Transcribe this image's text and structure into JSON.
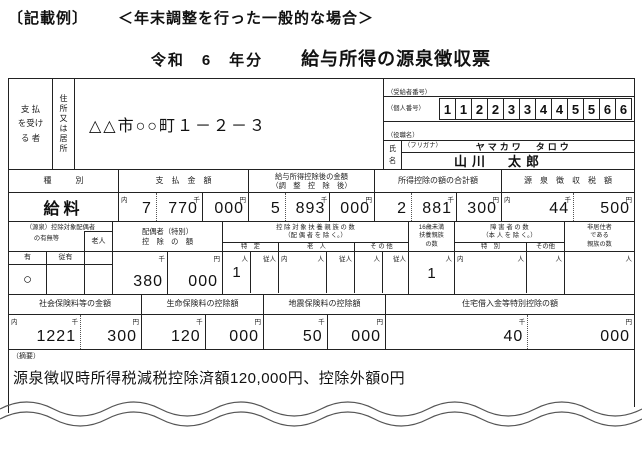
{
  "header": {
    "example_label": "〔記載例〕",
    "case_label": "＜年末調整を行った一般的な場合＞",
    "year_label": "令和　6　年分",
    "form_title": "給与所得の源泉徴収票"
  },
  "markers": {
    "uchi": "内",
    "sen": "千",
    "en": "円",
    "nin": "人",
    "junin": "従人"
  },
  "payee": {
    "payer_label_lines": [
      "支 払",
      "を受け",
      "る 者"
    ],
    "address_label": "住所又は居所",
    "address": "△△市○○町１－２－３",
    "recipient_no_label": "（受給者番号）",
    "personal_no_label": "（個人番号）",
    "personal_no_digits": [
      "1",
      "1",
      "2",
      "2",
      "3",
      "3",
      "4",
      "4",
      "5",
      "5",
      "6",
      "6"
    ],
    "role_label": "（役職名）",
    "name_label_chars": [
      "氏",
      "名"
    ],
    "furigana_label": "（フリガナ）",
    "furigana": "ヤマカワ　タロウ",
    "name": "山川　太郎"
  },
  "income": {
    "type_header": "種　　　別",
    "payment_header": "支　払　金　額",
    "after_header1": "給与所得控除後の金額",
    "after_header2": "（調　整　控　除　後）",
    "deduction_total_header": "所得控除の額の合計額",
    "tax_header": "源　泉　徴　収　税　額",
    "type_value": "給料",
    "payment_segs": [
      "7",
      "770",
      "000"
    ],
    "after_segs": [
      "5",
      "893",
      "000"
    ],
    "deduction_total_segs": [
      "2",
      "881",
      "300"
    ],
    "tax_segs": [
      "44",
      "500"
    ]
  },
  "spouse": {
    "group_header1": "（源泉）控除対象配偶者",
    "group_header2": "の有無等",
    "elderly_label": "老人",
    "has_label": "有",
    "sub_has_label": "従有",
    "has_value": "○",
    "deduction_header1": "配偶者（特別）",
    "deduction_header2": "控　除　の　額",
    "deduction_segs": [
      "380",
      "000"
    ]
  },
  "dependents": {
    "group_header1": "控 除 対 象 扶 養 親 族 の 数",
    "group_header2": "（配 偶 者 を 除 く。）",
    "specific_label": "特　定",
    "elderly_label": "老　人",
    "other_label": "そ の 他",
    "specific_value": "1",
    "under16_lines": [
      "16歳未満",
      "扶養親族",
      "の数"
    ],
    "under16_value": "1",
    "disabled_header1": "障 害 者 の 数",
    "disabled_header2": "（本 人 を 除 く。）",
    "special_label": "特　別",
    "disabled_other_label": "その他",
    "nonresident_lines": [
      "非居住者",
      "である",
      "親族の数"
    ]
  },
  "deductions": {
    "social_header": "社会保険料等の金額",
    "life_header": "生命保険料の控除額",
    "quake_header": "地震保険料の控除額",
    "housing_header": "住宅借入金等特別控除の額",
    "social_segs": [
      "1221",
      "300"
    ],
    "life_segs": [
      "120",
      "000"
    ],
    "quake_segs": [
      "50",
      "000"
    ],
    "housing_segs": [
      "40",
      "000"
    ]
  },
  "remarks": {
    "label": "（摘要）",
    "text": "源泉徴収時所得税減税控除済額120,000円、控除外額0円"
  }
}
